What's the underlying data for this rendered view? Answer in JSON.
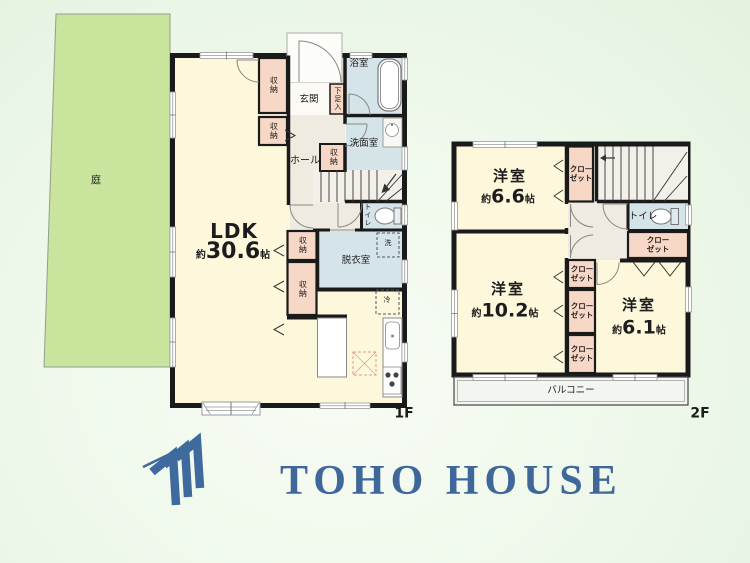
{
  "title": "floor-plan",
  "colors": {
    "wall": "#1a1a1a",
    "room_cream": "#fdf8dc",
    "wet_blue": "#d4e4e9",
    "closet_pink": "#f7d7c5",
    "hall_gray": "#efebe0",
    "garden_green": "#c9e49c",
    "logo_blue": "#3e6a9d"
  },
  "garden": {
    "label": "庭"
  },
  "f1": {
    "floor_label": "1F",
    "ldk": {
      "name": "LDK",
      "approx": "約",
      "value": "30.6",
      "unit": "帖"
    },
    "genkan": "玄関",
    "shoe_box": "下足入",
    "bath": "浴室",
    "washroom": "洗面室",
    "hall": "ホール",
    "storage": "収納",
    "dressing": "脱衣室",
    "toilet": "トイレ",
    "washer": "洗",
    "fridge": "冷"
  },
  "f2": {
    "floor_label": "2F",
    "bed1": {
      "name": "洋室",
      "approx": "約",
      "value": "6.6",
      "unit": "帖"
    },
    "bed2": {
      "name": "洋室",
      "approx": "約",
      "value": "10.2",
      "unit": "帖"
    },
    "bed3": {
      "name": "洋室",
      "approx": "約",
      "value": "6.1",
      "unit": "帖"
    },
    "closet_l1": "クロー",
    "closet_l2": "ゼット",
    "toilet": "トイレ",
    "balcony": "バルコニー"
  },
  "logo": {
    "text": "TOHO HOUSE"
  }
}
